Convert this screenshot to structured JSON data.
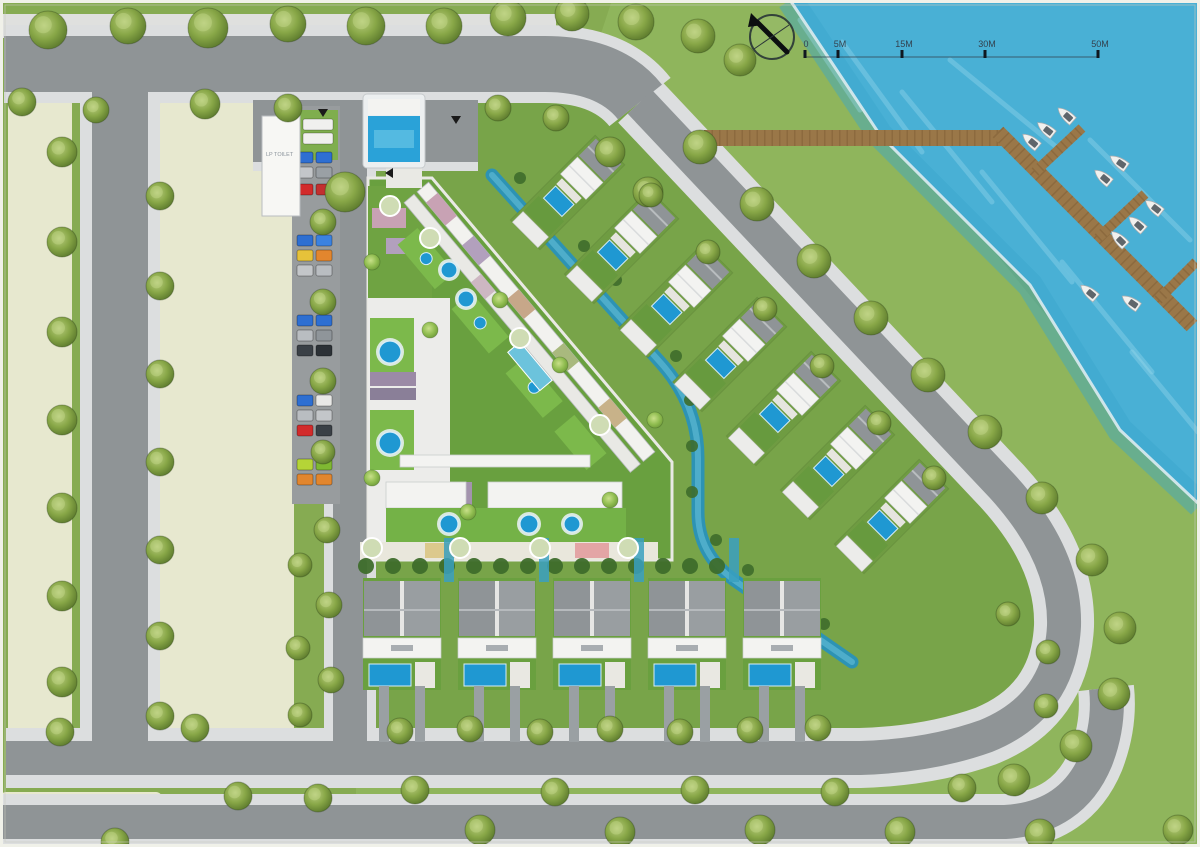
{
  "plan_name": "waterfront-residential-master-plan",
  "colors": {
    "grass_base": "#86ab52",
    "grass_bright": "#8fb55c",
    "grass_dev": "#78a449",
    "water": "#49b0d5",
    "water_streak": "#9fdcef",
    "shore_edge": "#dcebf0",
    "parcel": "#e7e8cf",
    "road": "#8f9496",
    "sidewalk": "#dcdedf",
    "tree_mid": "#88a747",
    "tree_light": "#b8cc7e",
    "tree_dark": "#5e7c2e",
    "palm_light": "#a8cf6a",
    "palm_dark": "#6f9a3a",
    "boardwalk": "#9a7748",
    "plank": "#7d5c34",
    "pool": "#1f98d2",
    "canal": "#2d93b4",
    "canal_hi": "#56b4cf",
    "roof_white": "#f3f3f1",
    "roof_grey": "#8f9497",
    "roof_grey2": "#999ea1",
    "hedge": "#3e6d2b",
    "frame": "#f0f1e9"
  },
  "scalebar": {
    "labels": [
      "0",
      "5M",
      "15M",
      "30M",
      "50M"
    ],
    "tick_x": [
      805,
      838,
      902,
      985,
      1098
    ],
    "label_y": 47,
    "line_y": 57
  },
  "north_arrow": {
    "cx": 772,
    "cy": 37,
    "r": 22
  },
  "guard_building": {
    "label": "LP TOILET",
    "x": 262,
    "y": 116,
    "w": 38,
    "h": 100
  },
  "lawns": {
    "bright": "612,0 790,0 1200,505 1200,847 356,847 356,780",
    "dev": "M 358 92 L 640 92 L 1003 492 Q 1062 556 1060 626 Q 1056 702 986 734 Q 928 752 858 752 L 358 752 Z"
  },
  "water": {
    "poly": "790,0 1200,0 1200,505 1120,430 1030,285 880,135",
    "shore": "M 790 0 L 880 135 L 1030 285 L 1120 430 L 1200 505",
    "streaks": [
      [
        800,
        20,
        860,
        110
      ],
      [
        842,
        42,
        922,
        152
      ],
      [
        902,
        92,
        992,
        202
      ],
      [
        982,
        172,
        1072,
        282
      ],
      [
        1062,
        262,
        1152,
        372
      ],
      [
        1132,
        352,
        1198,
        432
      ],
      [
        950,
        60,
        1060,
        150
      ],
      [
        1090,
        140,
        1190,
        240
      ]
    ]
  },
  "parcels": [
    [
      8,
      98,
      64,
      638
    ],
    [
      160,
      98,
      134,
      638
    ],
    [
      0,
      792,
      162,
      55
    ]
  ],
  "bands": [
    [
      0,
      14,
      556,
      24,
      "#dfe0de"
    ]
  ],
  "roads": [
    {
      "d": "M 4 64 H 545 Q 610 64 640 102",
      "w": 56,
      "sw": 78
    },
    {
      "d": "M 640 102 L 1002 486 Q 1066 556 1064 626 Q 1060 706 986 736 Q 930 756 860 758 L 6 758",
      "w": 34,
      "sw": 60
    },
    {
      "d": "M 0 822 H 1005 Q 1072 818 1096 760 Q 1110 724 1106 688",
      "w": 34,
      "sw": 56
    },
    {
      "d": "M 120 66 V 756",
      "w": 56,
      "sw": 80
    },
    {
      "d": "M 350 100 V 758",
      "w": 34,
      "sw": 52
    },
    {
      "d": "M 253 131 H 478",
      "w": 62,
      "sw": 80
    }
  ],
  "marina": {
    "board": [
      704,
      130,
      298,
      16
    ],
    "diag": "M 998 132 L 1192 326",
    "fingers": [
      "M 1035 172 L 1082 128",
      "M 1098 238 L 1145 194",
      "M 1158 300 L 1196 262"
    ]
  },
  "boats": [
    [
      1032,
      142,
      -50
    ],
    [
      1047,
      130,
      -52
    ],
    [
      1067,
      116,
      -48
    ],
    [
      1104,
      178,
      -50
    ],
    [
      1120,
      163,
      -55
    ],
    [
      1138,
      225,
      -48
    ],
    [
      1155,
      208,
      -52
    ],
    [
      1120,
      240,
      -45
    ],
    [
      1090,
      293,
      -50
    ],
    [
      1132,
      303,
      -55
    ]
  ],
  "complex": {
    "outline": "368,178 432,178 672,462 672,560 368,560",
    "plaza": [
      368,
      298,
      82,
      260
    ],
    "upper_garden": [
      368,
      186,
      64,
      112
    ],
    "diag": {
      "x": 424,
      "y": 186,
      "rot": 50,
      "bars": [
        [
          0,
          -6,
          352,
          15,
          "#f2f2ef"
        ],
        [
          0,
          13,
          352,
          13,
          "#e9e9e5"
        ]
      ],
      "patches": [
        [
          14,
          -6,
          30,
          15,
          "#c8a2b4"
        ],
        [
          70,
          -6,
          26,
          15,
          "#b2a0bd"
        ],
        [
          140,
          -6,
          26,
          15,
          "#c7a789"
        ],
        [
          210,
          -6,
          24,
          15,
          "#a9b97e"
        ],
        [
          282,
          -6,
          26,
          15,
          "#c8b289"
        ],
        [
          104,
          13,
          22,
          13,
          "#cdb7c2"
        ]
      ],
      "gardens": [
        [
          28,
          32,
          58,
          26
        ],
        [
          112,
          32,
          58,
          26
        ],
        [
          196,
          32,
          58,
          26
        ],
        [
          272,
          32,
          50,
          26
        ]
      ],
      "gpools": [
        [
          57,
          45
        ],
        [
          141,
          45
        ],
        [
          225,
          45
        ]
      ]
    },
    "lap_pool": [
      520,
      342,
      50,
      16,
      50
    ],
    "patches_abs": [
      [
        372,
        208,
        34,
        20,
        "#c8a2b4"
      ],
      [
        386,
        238,
        30,
        16,
        "#b2a0bd"
      ],
      [
        370,
        372,
        46,
        14,
        "#9b8aa6"
      ],
      [
        370,
        388,
        46,
        12,
        "#8a7f98"
      ],
      [
        452,
        482,
        20,
        26,
        "#a393ad"
      ],
      [
        596,
        482,
        24,
        26,
        "#d98f6e"
      ]
    ],
    "garden_squares": [
      [
        370,
        318,
        44,
        58
      ],
      [
        370,
        410,
        44,
        60
      ]
    ],
    "pools": [
      [
        390,
        352,
        11
      ],
      [
        390,
        443,
        11
      ],
      [
        449,
        270,
        8
      ],
      [
        466,
        299,
        8
      ],
      [
        449,
        524,
        9
      ],
      [
        529,
        524,
        9
      ],
      [
        572,
        524,
        8
      ]
    ],
    "bars": [
      [
        400,
        455,
        190,
        12
      ],
      [
        386,
        482,
        80,
        26
      ],
      [
        488,
        482,
        134,
        26
      ]
    ],
    "garden_strip": [
      386,
      508,
      240,
      34
    ],
    "walk": [
      360,
      542,
      298,
      18
    ],
    "walk_patches": [
      [
        425,
        543,
        34,
        15,
        "#dcc98c"
      ],
      [
        575,
        543,
        34,
        15,
        "#e3a5a5"
      ]
    ]
  },
  "canal": {
    "d": "M 492 175 L 660 362 Q 698 404 698 458 L 698 512 Q 698 554 734 580 L 852 662",
    "w": 13
  },
  "canal_bushes": [
    [
      520,
      178
    ],
    [
      552,
      212
    ],
    [
      584,
      246
    ],
    [
      616,
      280
    ],
    [
      648,
      316
    ],
    [
      676,
      356
    ],
    [
      690,
      400
    ],
    [
      692,
      446
    ],
    [
      692,
      492
    ],
    [
      716,
      540
    ],
    [
      748,
      570
    ],
    [
      788,
      598
    ],
    [
      824,
      624
    ]
  ],
  "villas": {
    "points": [
      [
        610,
        150
      ],
      [
        664,
        204
      ],
      [
        718,
        258
      ],
      [
        772,
        312
      ],
      [
        826,
        366
      ],
      [
        880,
        420
      ],
      [
        934,
        474
      ]
    ],
    "angle": 45
  },
  "townhouses": {
    "xs": [
      363,
      458,
      553,
      648,
      743
    ],
    "y": 578,
    "stripes_x": [
      449,
      544,
      639,
      734
    ]
  },
  "hedge_row": {
    "y": 566,
    "x0": 366,
    "step": 27,
    "count": 14
  },
  "parking": {
    "pave": [
      292,
      106,
      48,
      398
    ],
    "pad": [
      296,
      110,
      42,
      50
    ],
    "vans": [
      [
        303,
        119
      ],
      [
        303,
        133
      ]
    ],
    "rows": [
      [
        157,
        "#2e6fd2",
        "#2e6fd2"
      ],
      [
        172,
        "#c3c6c9",
        "#9aa0a5"
      ],
      [
        189,
        "#d22b2b",
        "#c23030"
      ],
      [
        240,
        "#2e6fd2",
        "#3b82e0"
      ],
      [
        255,
        "#e6c23a",
        "#e2862e"
      ],
      [
        270,
        "#c3c6c9",
        "#b9bdc1"
      ],
      [
        320,
        "#2e6fd2",
        "#2e6fd2"
      ],
      [
        335,
        "#b9bdc1",
        "#8f959a"
      ],
      [
        350,
        "#3a4046",
        "#2c3136"
      ],
      [
        400,
        "#2e6fd2",
        "#e8e8e6"
      ],
      [
        415,
        "#b9bdc1",
        "#c3c6c9"
      ],
      [
        430,
        "#d22b2b",
        "#3a4046"
      ],
      [
        464,
        "#b5d437",
        "#7fb832"
      ],
      [
        479,
        "#e2862e",
        "#e2862e"
      ]
    ]
  },
  "entrance": {
    "rim": [
      363,
      94,
      62,
      74
    ],
    "top": [
      368,
      99,
      52,
      16
    ],
    "pool": [
      368,
      116,
      52,
      46
    ],
    "inner": [
      374,
      130,
      40,
      18
    ],
    "walk": [
      386,
      160,
      36,
      28
    ],
    "arrows": [
      [
        323,
        113,
        "down"
      ],
      [
        456,
        120,
        "down"
      ],
      [
        389,
        173,
        "left"
      ]
    ]
  },
  "trees": [
    [
      48,
      30,
      19
    ],
    [
      128,
      26,
      18
    ],
    [
      208,
      28,
      20
    ],
    [
      288,
      24,
      18
    ],
    [
      366,
      26,
      19
    ],
    [
      444,
      26,
      18
    ],
    [
      508,
      18,
      18
    ],
    [
      572,
      14,
      17
    ],
    [
      636,
      22,
      18
    ],
    [
      698,
      36,
      17
    ],
    [
      740,
      60,
      16
    ],
    [
      22,
      102,
      14
    ],
    [
      96,
      110,
      13
    ],
    [
      205,
      104,
      15
    ],
    [
      288,
      108,
      14
    ],
    [
      345,
      192,
      20
    ],
    [
      498,
      108,
      13
    ],
    [
      556,
      118,
      13
    ],
    [
      610,
      152,
      15
    ],
    [
      648,
      192,
      15
    ],
    [
      62,
      152,
      15
    ],
    [
      62,
      242,
      15
    ],
    [
      62,
      332,
      15
    ],
    [
      62,
      420,
      15
    ],
    [
      62,
      508,
      15
    ],
    [
      62,
      596,
      15
    ],
    [
      62,
      682,
      15
    ],
    [
      160,
      196,
      14
    ],
    [
      160,
      286,
      14
    ],
    [
      160,
      374,
      14
    ],
    [
      160,
      462,
      14
    ],
    [
      160,
      550,
      14
    ],
    [
      160,
      636,
      14
    ],
    [
      160,
      716,
      14
    ],
    [
      323,
      222,
      13
    ],
    [
      323,
      302,
      13
    ],
    [
      323,
      381,
      13
    ],
    [
      323,
      452,
      12
    ],
    [
      327,
      530,
      13
    ],
    [
      329,
      605,
      13
    ],
    [
      331,
      680,
      13
    ],
    [
      300,
      565,
      12
    ],
    [
      298,
      648,
      12
    ],
    [
      300,
      715,
      12
    ],
    [
      700,
      147,
      17
    ],
    [
      757,
      204,
      17
    ],
    [
      814,
      261,
      17
    ],
    [
      871,
      318,
      17
    ],
    [
      928,
      375,
      17
    ],
    [
      985,
      432,
      17
    ],
    [
      1042,
      498,
      16
    ],
    [
      1092,
      560,
      16
    ],
    [
      1120,
      628,
      16
    ],
    [
      1114,
      694,
      16
    ],
    [
      1076,
      746,
      16
    ],
    [
      1014,
      780,
      16
    ],
    [
      651,
      195,
      12
    ],
    [
      708,
      252,
      12
    ],
    [
      765,
      309,
      12
    ],
    [
      822,
      366,
      12
    ],
    [
      879,
      423,
      12
    ],
    [
      934,
      478,
      12
    ],
    [
      400,
      731,
      13
    ],
    [
      470,
      729,
      13
    ],
    [
      540,
      732,
      13
    ],
    [
      610,
      729,
      13
    ],
    [
      680,
      732,
      13
    ],
    [
      750,
      730,
      13
    ],
    [
      818,
      728,
      13
    ],
    [
      415,
      790,
      14
    ],
    [
      555,
      792,
      14
    ],
    [
      695,
      790,
      14
    ],
    [
      835,
      792,
      14
    ],
    [
      962,
      788,
      14
    ],
    [
      480,
      830,
      15
    ],
    [
      620,
      832,
      15
    ],
    [
      760,
      830,
      15
    ],
    [
      900,
      832,
      15
    ],
    [
      1040,
      834,
      15
    ],
    [
      1178,
      830,
      15
    ],
    [
      238,
      796,
      14
    ],
    [
      318,
      798,
      14
    ],
    [
      60,
      732,
      14
    ],
    [
      195,
      728,
      14
    ],
    [
      115,
      842,
      14
    ],
    [
      1008,
      614,
      12
    ],
    [
      1048,
      652,
      12
    ],
    [
      1046,
      706,
      12
    ]
  ],
  "palms": [
    [
      372,
      262,
      8
    ],
    [
      430,
      330,
      8
    ],
    [
      372,
      478,
      8
    ],
    [
      500,
      300,
      8
    ],
    [
      560,
      365,
      8
    ],
    [
      468,
      512,
      8
    ],
    [
      610,
      500,
      8
    ],
    [
      655,
      420,
      8
    ]
  ],
  "ring_trees": [
    [
      430,
      238,
      10
    ],
    [
      520,
      338,
      10
    ],
    [
      600,
      425,
      10
    ],
    [
      372,
      548,
      10
    ],
    [
      460,
      548,
      10
    ],
    [
      540,
      548,
      10
    ],
    [
      628,
      548,
      10
    ],
    [
      390,
      206,
      10
    ]
  ]
}
